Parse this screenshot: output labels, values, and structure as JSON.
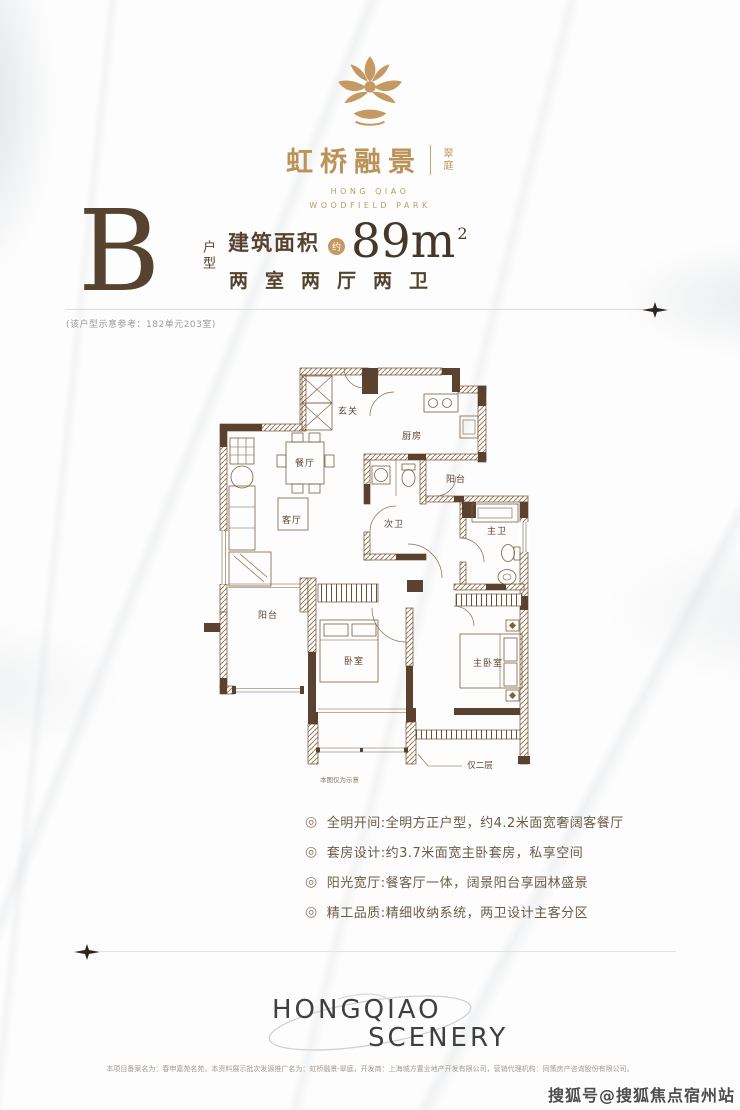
{
  "brand": {
    "name_cn": "虹桥融景",
    "suffix_cn": "翠庭",
    "en_line1": "HONG QIAO",
    "en_line2": "WOODFIELD PARK"
  },
  "unit": {
    "type_letter": "B",
    "type_label": "户型",
    "area_label": "建筑面积",
    "area_approx": "约",
    "area_value": "89m",
    "area_sup": "2",
    "layout_desc": "两室两厅两卫",
    "reference_note": "(该户型示意参考：182单元203室)"
  },
  "floorplan": {
    "rooms": {
      "entry": "玄关",
      "kitchen": "厨房",
      "dining": "餐厅",
      "balcony_right": "阳台",
      "living": "客厅",
      "bath2": "次卫",
      "bath_master": "主卫",
      "balcony_left": "阳台",
      "bedroom": "卧室",
      "bedroom_master": "主卧室"
    },
    "annotation_floor": "仅二层",
    "disclaimer": "本图仅为示意"
  },
  "features": [
    "全明开间:全明方正户型，约4.2米面宽奢阔客餐厅",
    "套房设计:约3.7米面宽主卧套房，私享空间",
    "阳光宽厅:餐客厅一体，阔景阳台享园林盛景",
    "精工品质:精细收纳系统，两卫设计主客分区"
  ],
  "footer": {
    "logo_line1": "HONGQIAO",
    "logo_line2": "SCENERY",
    "fineprint": "本项目备案名为：春申嘉苑名苑，本资料展示批次发源推广名为：虹桥融景·翠庭，开发商：上海城方置业地产开发有限公司，营销代理机构：同策房产咨询股份有限公司。"
  },
  "watermark": "搜狐号@搜狐焦点宿州站",
  "colors": {
    "gold": "#c39a63",
    "text_brown": "#55432f",
    "plan_brown": "#5d4430"
  }
}
